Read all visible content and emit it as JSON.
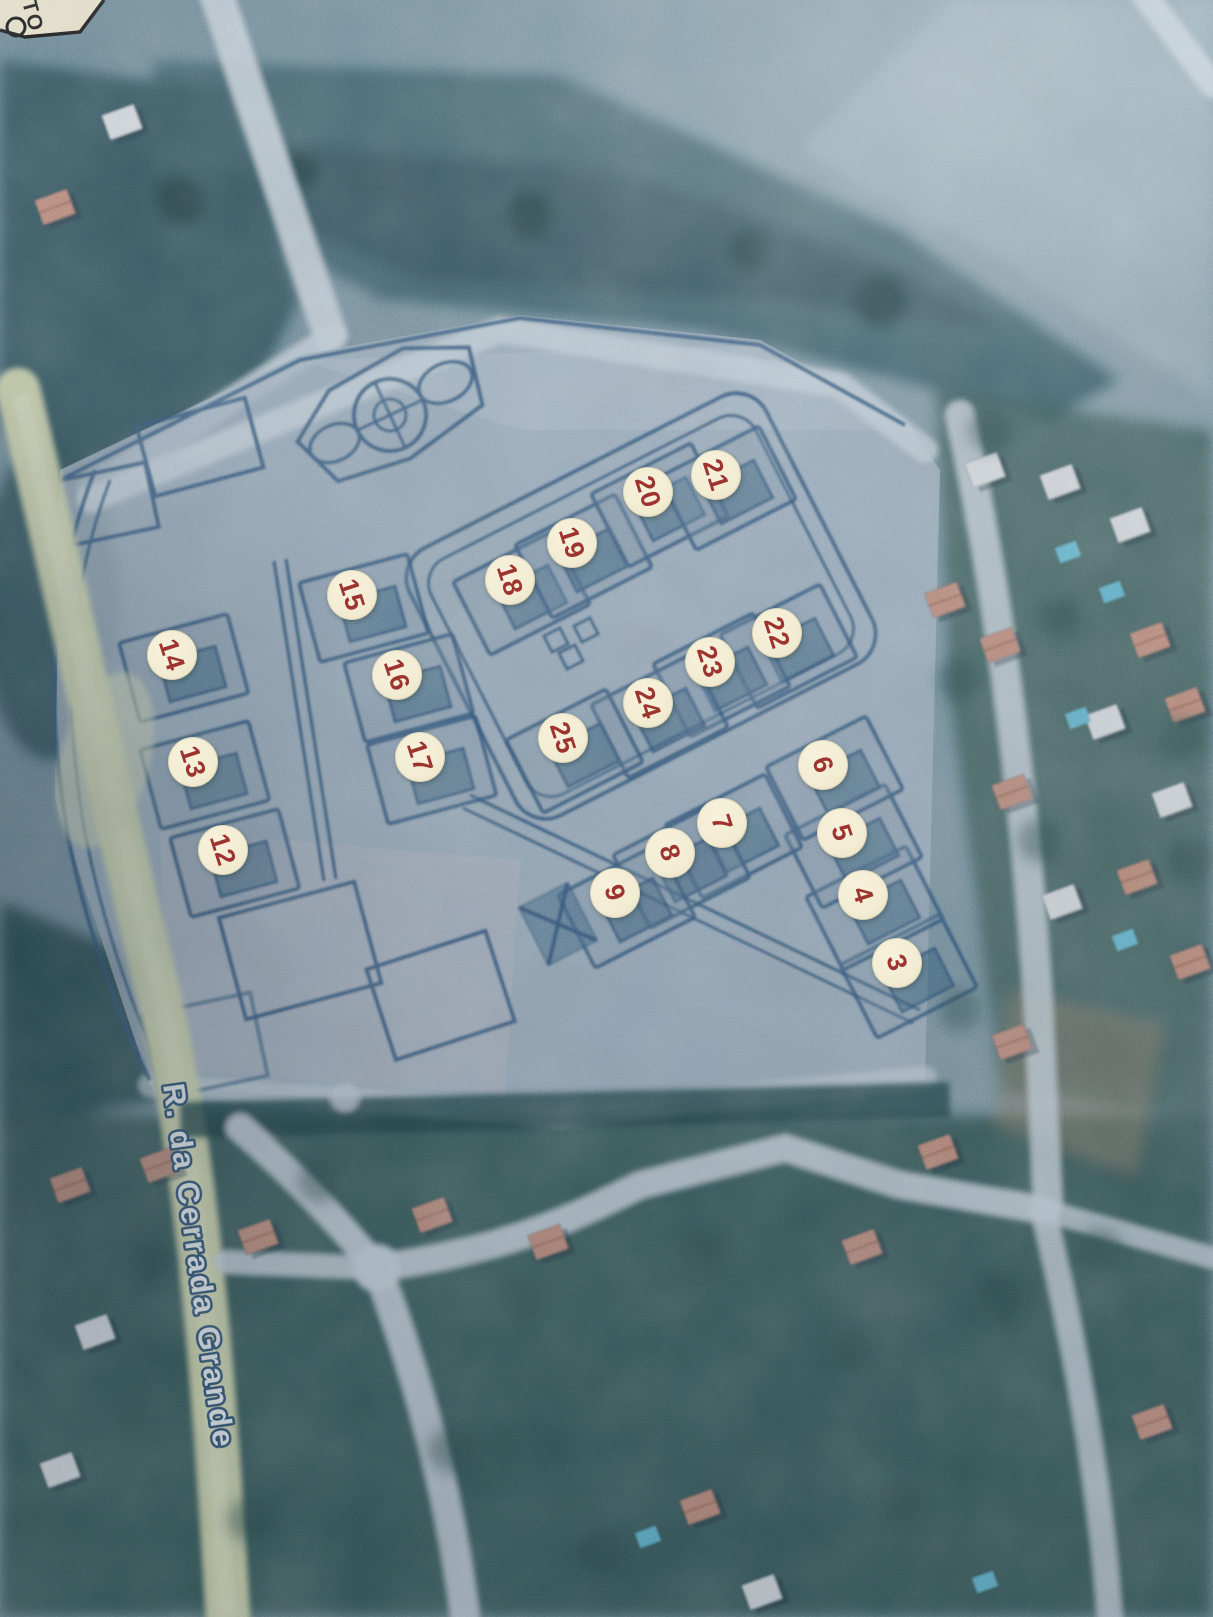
{
  "page": {
    "kind": "printed aerial allotment plan photograph"
  },
  "corner_label": {
    "text": "TO"
  },
  "street_label": {
    "text": "R. da Cerrada Grande"
  },
  "colors": {
    "marker_bg": "#f2ecd3",
    "marker_text": "#9e3430",
    "marker_glow": "#63a863",
    "plan_line": "#2a4e74",
    "plan_bg": "#a3b5c6",
    "road_pale": "#c6d3dd",
    "road_yellow": "#d6dcae",
    "street_text": "#eef3f5",
    "street_outline": "#2b4d6e",
    "label_bg": "#efe7cb",
    "label_text": "#1a1a1a",
    "field_dark": "#3b5c66",
    "veg_dark": "#2e4f58"
  },
  "markers": [
    {
      "n": "3",
      "x": 897,
      "y": 963,
      "cluster": "right"
    },
    {
      "n": "4",
      "x": 863,
      "y": 895,
      "cluster": "right"
    },
    {
      "n": "5",
      "x": 842,
      "y": 833,
      "cluster": "right"
    },
    {
      "n": "6",
      "x": 823,
      "y": 765,
      "cluster": "right"
    },
    {
      "n": "7",
      "x": 722,
      "y": 823,
      "cluster": "right"
    },
    {
      "n": "8",
      "x": 670,
      "y": 853,
      "cluster": "right"
    },
    {
      "n": "9",
      "x": 615,
      "y": 893,
      "cluster": "right"
    },
    {
      "n": "12",
      "x": 223,
      "y": 850,
      "cluster": "left"
    },
    {
      "n": "13",
      "x": 193,
      "y": 762,
      "cluster": "left"
    },
    {
      "n": "14",
      "x": 172,
      "y": 655,
      "cluster": "left"
    },
    {
      "n": "15",
      "x": 352,
      "y": 595,
      "cluster": "left"
    },
    {
      "n": "16",
      "x": 397,
      "y": 675,
      "cluster": "left"
    },
    {
      "n": "17",
      "x": 420,
      "y": 757,
      "cluster": "left"
    },
    {
      "n": "18",
      "x": 510,
      "y": 580,
      "cluster": "mid"
    },
    {
      "n": "19",
      "x": 572,
      "y": 543,
      "cluster": "mid"
    },
    {
      "n": "20",
      "x": 648,
      "y": 492,
      "cluster": "mid"
    },
    {
      "n": "21",
      "x": 716,
      "y": 475,
      "cluster": "mid"
    },
    {
      "n": "22",
      "x": 777,
      "y": 633,
      "cluster": "mid"
    },
    {
      "n": "23",
      "x": 710,
      "y": 662,
      "cluster": "mid"
    },
    {
      "n": "24",
      "x": 648,
      "y": 703,
      "cluster": "mid"
    },
    {
      "n": "25",
      "x": 563,
      "y": 738,
      "cluster": "mid"
    }
  ]
}
